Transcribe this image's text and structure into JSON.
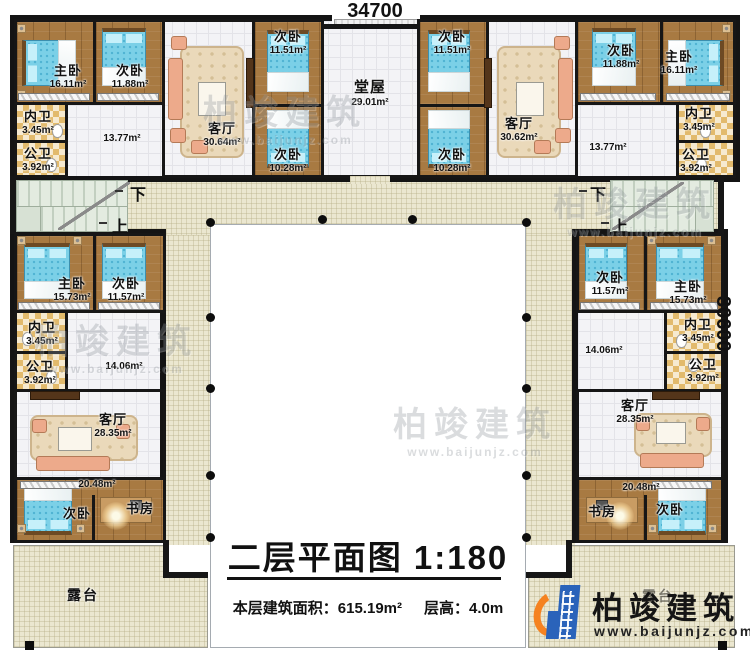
{
  "plan": {
    "title": "二层平面图",
    "scale": "1:180",
    "area_label": "本层建筑面积：",
    "area_value": "615.19m²",
    "floor_height_label": "层高：",
    "floor_height_value": "4.0m",
    "dim_width": "34700",
    "dim_height": "30600"
  },
  "stairs": {
    "down": "下",
    "up": "上"
  },
  "brand": {
    "name": "柏竣建筑",
    "site": "www.baijunjz.com"
  },
  "watermark": {
    "text": "柏竣建筑",
    "site": "www.baijunjz.com"
  },
  "colors": {
    "wall": "#141414",
    "wood_floor": "#a87a42",
    "bed": "#7bd0e7",
    "bath_tile": "#e2ba6c",
    "terrace": "#ebe7d0",
    "logo_blue": "#2a63ba",
    "logo_orange": "#f58220"
  },
  "labels": [
    {
      "name": "主卧",
      "area": "16.11m²"
    },
    {
      "name": "次卧",
      "area": "11.88m²"
    },
    {
      "name": "客厅",
      "area": "30.64m²"
    },
    {
      "name": "",
      "area": "13.77m²"
    },
    {
      "name": "内卫",
      "area": "3.45m²"
    },
    {
      "name": "公卫",
      "area": "3.92m²"
    },
    {
      "name": "次卧",
      "area": "11.51m²"
    },
    {
      "name": "次卧",
      "area": "10.28m²"
    },
    {
      "name": "堂屋",
      "area": "29.01m²"
    },
    {
      "name": "次卧",
      "area": "11.51m²"
    },
    {
      "name": "次卧",
      "area": "10.28m²"
    },
    {
      "name": "客厅",
      "area": "30.62m²"
    },
    {
      "name": "",
      "area": "13.77m²"
    },
    {
      "name": "次卧",
      "area": "11.88m²"
    },
    {
      "name": "主卧",
      "area": "16.11m²"
    },
    {
      "name": "内卫",
      "area": "3.45m²"
    },
    {
      "name": "公卫",
      "area": "3.92m²"
    },
    {
      "name": "主卧",
      "area": "15.73m²"
    },
    {
      "name": "次卧",
      "area": "11.57m²"
    },
    {
      "name": "内卫",
      "area": "3.45m²"
    },
    {
      "name": "公卫",
      "area": "3.92m²"
    },
    {
      "name": "",
      "area": "14.06m²"
    },
    {
      "name": "客厅",
      "area": "28.35m²"
    },
    {
      "name": "",
      "area": "20.48m²"
    },
    {
      "name": "次卧",
      "area": ""
    },
    {
      "name": "书房",
      "area": ""
    },
    {
      "name": "露台",
      "area": ""
    },
    {
      "name": "次卧",
      "area": "11.57m²"
    },
    {
      "name": "主卧",
      "area": "15.73m²"
    },
    {
      "name": "内卫",
      "area": "3.45m²"
    },
    {
      "name": "公卫",
      "area": "3.92m²"
    },
    {
      "name": "",
      "area": "14.06m²"
    },
    {
      "name": "客厅",
      "area": "28.35m²"
    },
    {
      "name": "",
      "area": "20.48m²"
    },
    {
      "name": "书房",
      "area": ""
    },
    {
      "name": "次卧",
      "area": ""
    },
    {
      "name": "露台",
      "area": ""
    }
  ]
}
